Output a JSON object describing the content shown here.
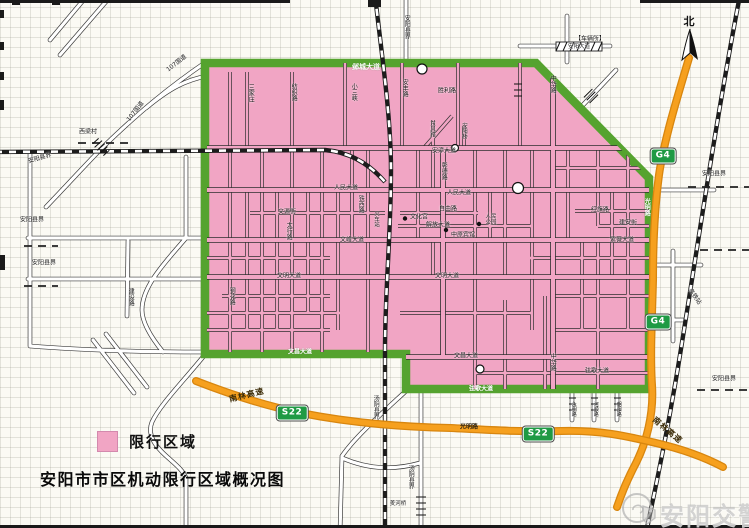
{
  "map": {
    "title": "安阳市市区机动限行区域概况图",
    "legend": {
      "label": "限行区域",
      "swatch_color": "#F1A5C4"
    },
    "watermark": {
      "text": "安阳交警"
    },
    "compass": {
      "label": "北"
    },
    "colors": {
      "restricted_fill": "#F1A5C4",
      "boundary_green": "#55A32F",
      "highway_orange": "#F6A01E",
      "railway_black": "#1C1C1C",
      "shield_green": "#1F9A44",
      "background": "#FBFAF4"
    },
    "shields": [
      {
        "id": "g4-shield",
        "t": "G4",
        "x": 663,
        "y": 156
      },
      {
        "id": "g4-shield",
        "t": "G4",
        "x": 658,
        "y": 322
      },
      {
        "id": "s22-shield",
        "t": "S22",
        "x": 292,
        "y": 413
      },
      {
        "id": "s22-shield",
        "t": "S22",
        "x": 538,
        "y": 434
      }
    ],
    "labels": [
      {
        "t": "邺城大道",
        "x": 366,
        "y": 68,
        "cls": "on-green",
        "s": 7
      },
      {
        "t": "文昌大道",
        "x": 300,
        "y": 353,
        "cls": "on-green"
      },
      {
        "t": "弦歌大道",
        "x": 481,
        "y": 390,
        "cls": "on-green"
      },
      {
        "t": "光明路",
        "x": 646,
        "y": 207,
        "cls": "on-green",
        "v": true
      },
      {
        "t": "107国道",
        "x": 177,
        "y": 64,
        "rot": -38
      },
      {
        "t": "107国道",
        "x": 136,
        "y": 112,
        "rot": -52
      },
      {
        "t": "西梁村",
        "x": 88,
        "y": 133
      },
      {
        "t": "安阳县界",
        "x": 40,
        "y": 159,
        "rot": -16
      },
      {
        "t": "安阳县界",
        "x": 32,
        "y": 221
      },
      {
        "t": "安阳县界",
        "x": 44,
        "y": 264
      },
      {
        "t": "安阳县界",
        "x": 406,
        "y": 27,
        "v": true
      },
      {
        "t": "安阳县界",
        "x": 714,
        "y": 175
      },
      {
        "t": "安阳县界",
        "x": 724,
        "y": 380
      },
      {
        "t": "汤阴县界",
        "x": 375,
        "y": 407,
        "v": true
      },
      {
        "t": "汤阴县界",
        "x": 410,
        "y": 477,
        "v": true
      },
      {
        "t": "三家庄",
        "x": 250,
        "y": 93,
        "v": true
      },
      {
        "t": "纺织路",
        "x": 293,
        "y": 92,
        "v": true
      },
      {
        "t": "小三峡",
        "x": 353,
        "y": 92,
        "v": true
      },
      {
        "t": "安丰路",
        "x": 404,
        "y": 88,
        "v": true
      },
      {
        "t": "胜利路",
        "x": 447,
        "y": 92
      },
      {
        "t": "中华路",
        "x": 552,
        "y": 84,
        "v": true
      },
      {
        "t": "中华路",
        "x": 552,
        "y": 362,
        "v": true
      },
      {
        "t": "【车辆所】",
        "x": 590,
        "y": 40,
        "s": 6
      },
      {
        "t": "安阳大道",
        "x": 579,
        "y": 47,
        "s": 5.5
      },
      {
        "t": "安漳大道",
        "x": 444,
        "y": 152
      },
      {
        "t": "人民大道",
        "x": 346,
        "y": 189
      },
      {
        "t": "人民大道",
        "x": 459,
        "y": 194
      },
      {
        "t": "文源街",
        "x": 287,
        "y": 213
      },
      {
        "t": "自由路",
        "x": 448,
        "y": 210
      },
      {
        "t": "解放大道",
        "x": 438,
        "y": 226
      },
      {
        "t": "红旗路",
        "x": 600,
        "y": 211
      },
      {
        "t": "建安街",
        "x": 628,
        "y": 224
      },
      {
        "t": "文峰大道",
        "x": 352,
        "y": 241
      },
      {
        "t": "紫薇大道",
        "x": 622,
        "y": 241
      },
      {
        "t": "文明大道",
        "x": 289,
        "y": 277
      },
      {
        "t": "文明大道",
        "x": 447,
        "y": 277
      },
      {
        "t": "文昌大道",
        "x": 466,
        "y": 357
      },
      {
        "t": "弦歌大道",
        "x": 597,
        "y": 372
      },
      {
        "t": "太行路",
        "x": 288,
        "y": 231,
        "v": true
      },
      {
        "t": "钢花路",
        "x": 231,
        "y": 296,
        "v": true
      },
      {
        "t": "彰德路",
        "x": 443,
        "y": 171,
        "v": true
      },
      {
        "t": "东风路",
        "x": 432,
        "y": 129,
        "v": true,
        "s": 5.5
      },
      {
        "t": "安阳桥",
        "x": 464,
        "y": 131,
        "v": true,
        "s": 5.5
      },
      {
        "t": "铁西路",
        "x": 360,
        "y": 204,
        "v": true
      },
      {
        "t": "火车站",
        "x": 376,
        "y": 219,
        "v": true,
        "s": 5.5
      },
      {
        "t": "建设路",
        "x": 130,
        "y": 297,
        "v": true
      },
      {
        "t": "永明路",
        "x": 573,
        "y": 409,
        "v": true,
        "s": 5
      },
      {
        "t": "河顺路",
        "x": 595,
        "y": 409,
        "v": true,
        "s": 5
      },
      {
        "t": "朝阳路",
        "x": 618,
        "y": 409,
        "v": true,
        "s": 5
      },
      {
        "t": "高铁站",
        "x": 694,
        "y": 297,
        "rot": 55
      },
      {
        "t": "羑河桥",
        "x": 398,
        "y": 504,
        "s": 5.5
      },
      {
        "t": "光明路",
        "x": 469,
        "y": 428,
        "cls": "on-orange"
      },
      {
        "t": "南林高速",
        "x": 247,
        "y": 396,
        "rot": -14,
        "cls": "hwy"
      },
      {
        "t": "南林高速",
        "x": 667,
        "y": 431,
        "rot": 40,
        "cls": "hwy"
      },
      {
        "t": "文化宫",
        "x": 419,
        "y": 218,
        "s": 6
      },
      {
        "t": "人民\n公园",
        "x": 491,
        "y": 220,
        "s": 5.5
      },
      {
        "t": "中原宾馆",
        "x": 463,
        "y": 236,
        "s": 6
      }
    ]
  }
}
